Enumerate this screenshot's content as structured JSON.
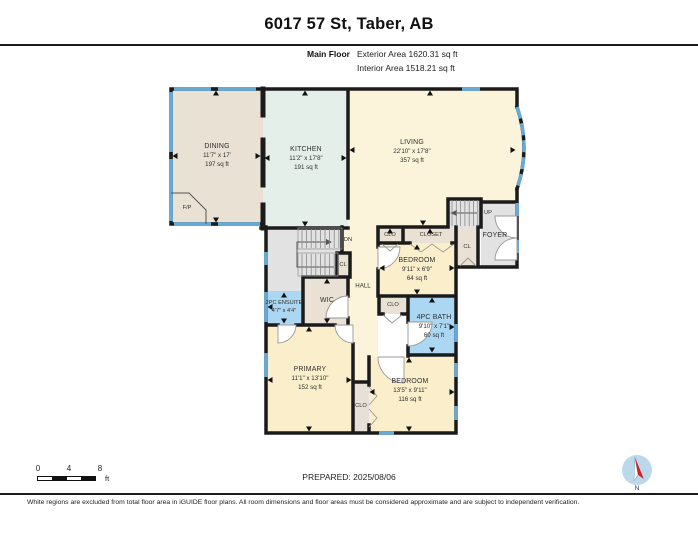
{
  "header": {
    "title": "6017 57 St, Taber, AB",
    "floor_label": "Main Floor",
    "exterior_area": "Exterior Area 1620.31 sq ft",
    "interior_area": "Interior Area 1518.21 sq ft"
  },
  "rooms": {
    "dining": {
      "name": "DINING",
      "dims": "11'7\" x 17'",
      "area": "197 sq ft"
    },
    "kitchen": {
      "name": "KITCHEN",
      "dims": "11'2\" x 17'8\"",
      "area": "191 sq ft"
    },
    "living": {
      "name": "LIVING",
      "dims": "22'10\" x 17'8\"",
      "area": "357 sq ft"
    },
    "foyer": {
      "name": "FOYER"
    },
    "bedroom_mid": {
      "name": "BEDROOM",
      "dims": "9'11\" x 6'9\"",
      "area": "64 sq ft"
    },
    "bath": {
      "name": "4PC BATH",
      "dims": "9'10\" x 7'1\"",
      "area": "60 sq ft"
    },
    "ensuite": {
      "name": "2PC ENSUITE",
      "dims": "4'7\" x 4'4\""
    },
    "wic": {
      "name": "WIC"
    },
    "hall": {
      "name": "HALL"
    },
    "primary": {
      "name": "PRIMARY",
      "dims": "11'1\" x 13'10\"",
      "area": "152 sq ft"
    },
    "bedroom_bottom": {
      "name": "BEDROOM",
      "dims": "13'5\" x 9'11\"",
      "area": "116 sq ft"
    }
  },
  "plan_labels": {
    "fireplace": "F/P",
    "stairs_up": "UP",
    "stairs_down": "DN",
    "closet_small": "CL",
    "closet_abbr": "CLO",
    "closet": "CLOSET"
  },
  "scale_bar": {
    "ticks": [
      "0",
      "4",
      "8"
    ],
    "unit": "ft"
  },
  "compass": {
    "north_label": "N"
  },
  "footer": {
    "prepared": "PREPARED: 2025/08/06",
    "disclaimer": "White regions are excluded from total floor area in iGUIDE floor plans. All room dimensions and floor areas must be considered approximate and are subject to independent verification."
  },
  "colors": {
    "wall": "#1b1b1b",
    "window_blue": "#66abd8",
    "dining_tan": "#e9e1d3",
    "kitchen_mint": "#e4efe9",
    "living_cream": "#fbf4da",
    "bedroom_cream": "#faefca",
    "bath_blue": "#abd7f2",
    "stair_gray": "#e2e2e2",
    "closet_tan": "#e9e1d3",
    "closet_gray": "#e6e1d8",
    "compass_red": "#cf2027",
    "compass_blue": "#bcd9ec"
  }
}
